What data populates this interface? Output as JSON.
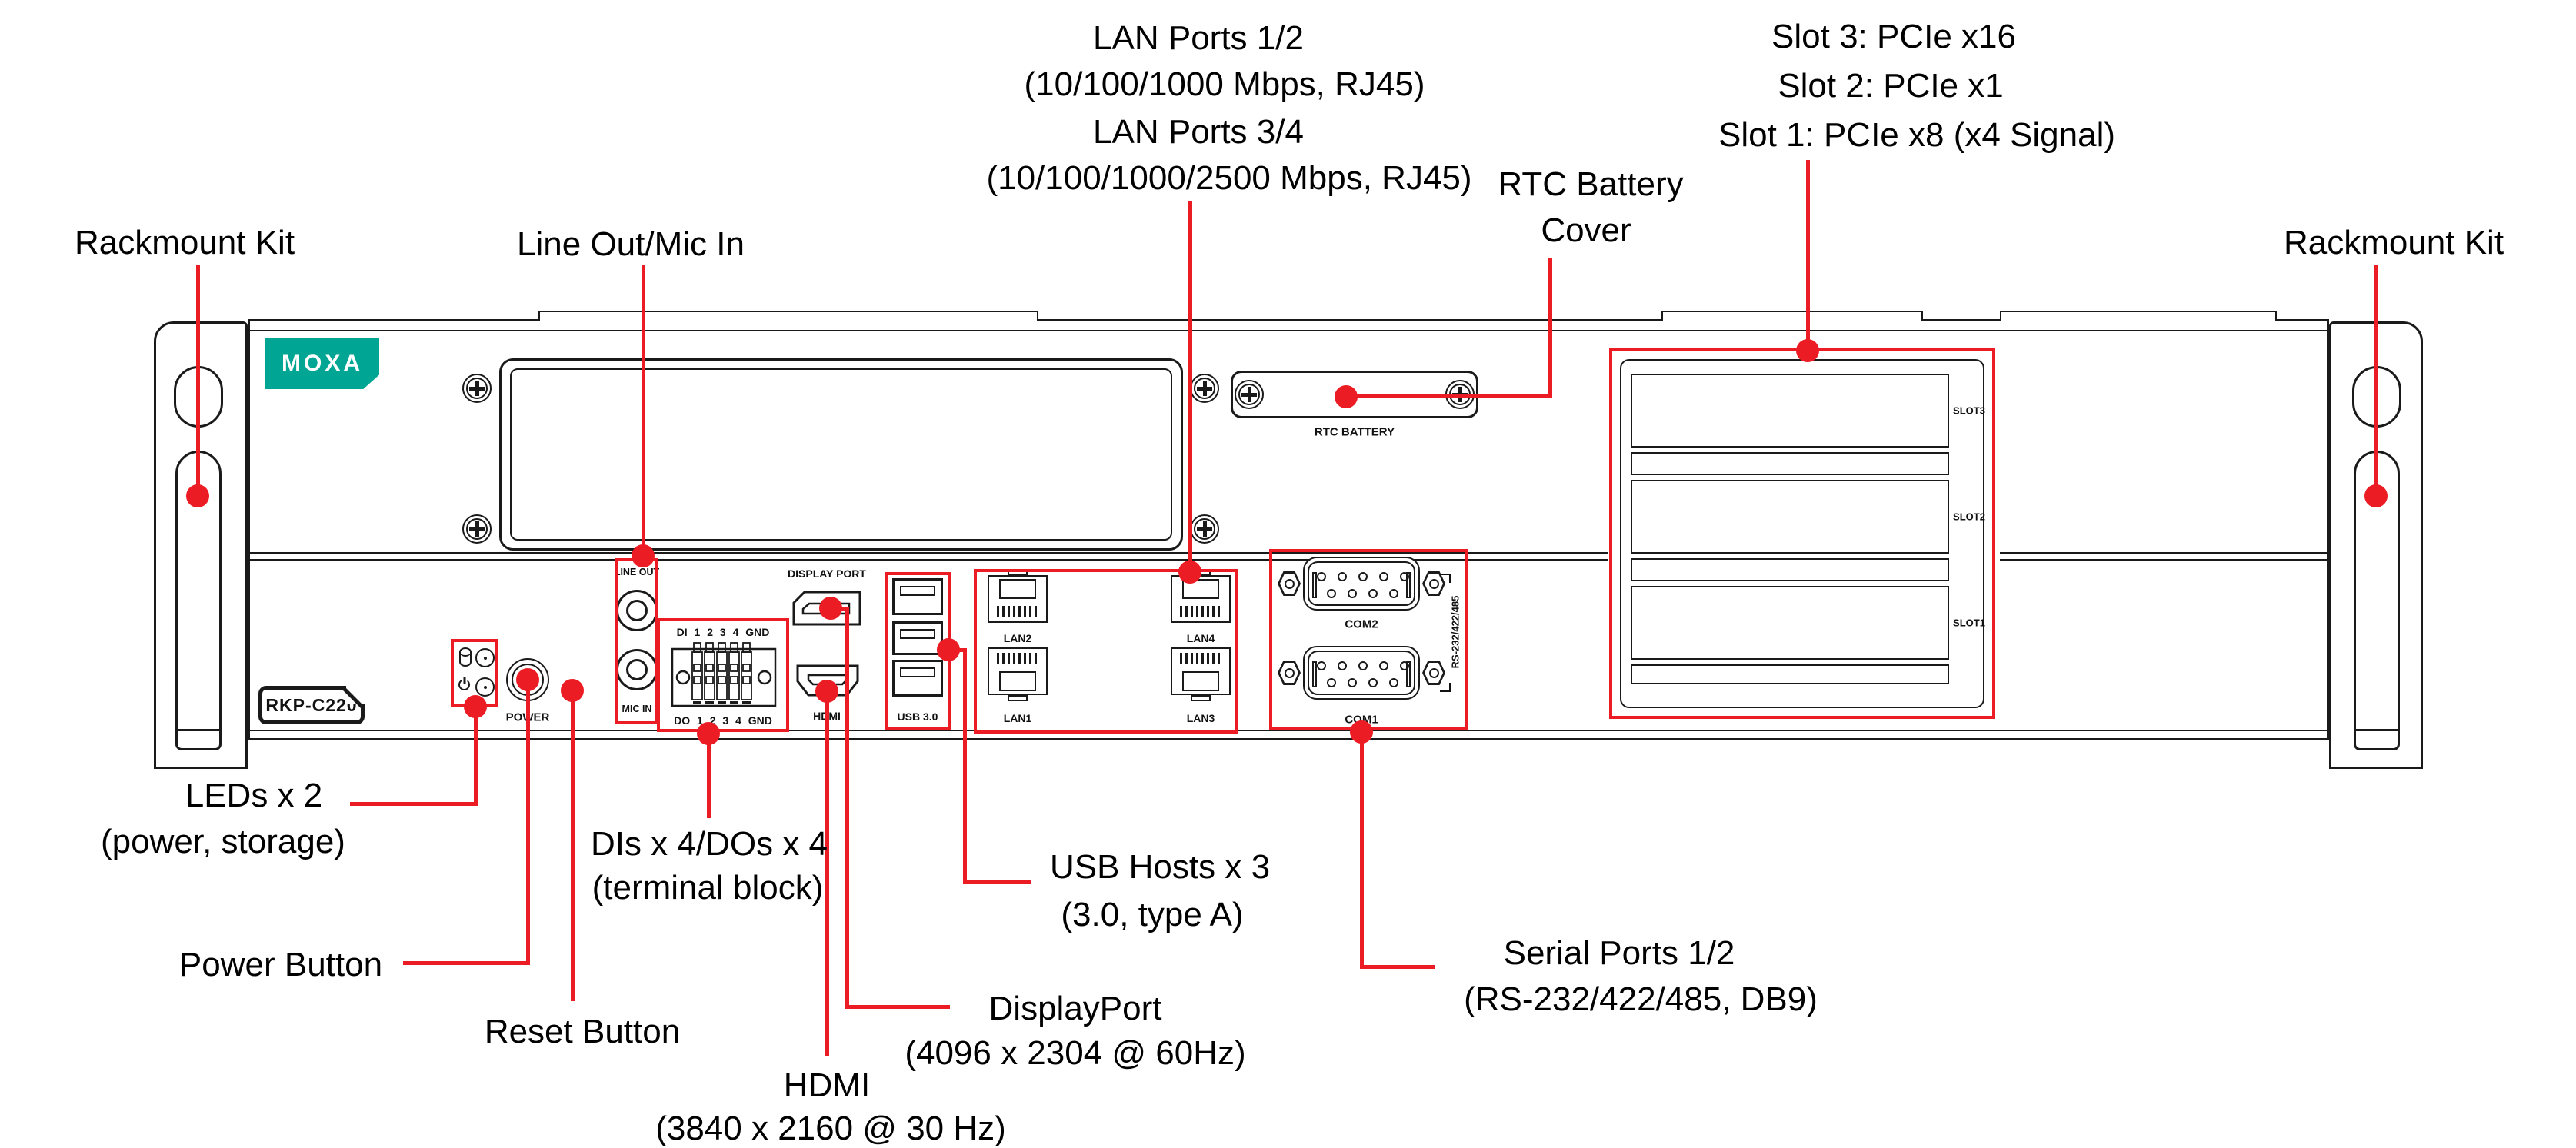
{
  "colors": {
    "accent_red": "#EC1C24",
    "brand_teal": "#00A693",
    "line_black": "#1a1a1a"
  },
  "callouts": {
    "rackmount_left": "Rackmount Kit",
    "line_out_mic_in": "Line Out/Mic In",
    "lan12_title": "LAN Ports 1/2",
    "lan12_sub": "(10/100/1000 Mbps, RJ45)",
    "lan34_title": "LAN Ports 3/4",
    "lan34_sub": "(10/100/1000/2500 Mbps, RJ45)",
    "rtc_title": "RTC Battery",
    "rtc_sub": "Cover",
    "slot3": "Slot 3: PCIe x16",
    "slot2": "Slot 2: PCIe x1",
    "slot1": "Slot 1: PCIe x8 (x4 Signal)",
    "rackmount_right": "Rackmount Kit",
    "leds_title": "LEDs x 2",
    "leds_sub": "(power, storage)",
    "power_button": "Power Button",
    "reset_button": "Reset Button",
    "dido_title": "DIs x 4/DOs x 4",
    "dido_sub": "(terminal block)",
    "hdmi_title": "HDMI",
    "hdmi_sub": "(3840 x 2160 @ 30 Hz)",
    "displayport_title": "DisplayPort",
    "displayport_sub": "(4096 x 2304 @ 60Hz)",
    "usb_title": "USB Hosts x 3",
    "usb_sub": "(3.0, type A)",
    "serial_title": "Serial Ports 1/2",
    "serial_sub": "(RS-232/422/485, DB9)"
  },
  "device": {
    "brand": "MOXA",
    "model": "RKP-C220",
    "silkscreen": {
      "line_out": "LINE OUT",
      "mic_in": "MIC IN",
      "power": "POWER",
      "di_row": "DI 1 2 3 4 GND",
      "do_row": "DO 1 2 3 4 GND",
      "display_port": "DISPLAY PORT",
      "hdmi": "HDMI",
      "usb": "USB 3.0",
      "lan1": "LAN1",
      "lan2": "LAN2",
      "lan3": "LAN3",
      "lan4": "LAN4",
      "com1": "COM1",
      "com2": "COM2",
      "serial_modes": "RS-232/422/485",
      "rtc_battery": "RTC BATTERY",
      "slot1": "SLOT1",
      "slot2": "SLOT2",
      "slot3": "SLOT3"
    }
  }
}
